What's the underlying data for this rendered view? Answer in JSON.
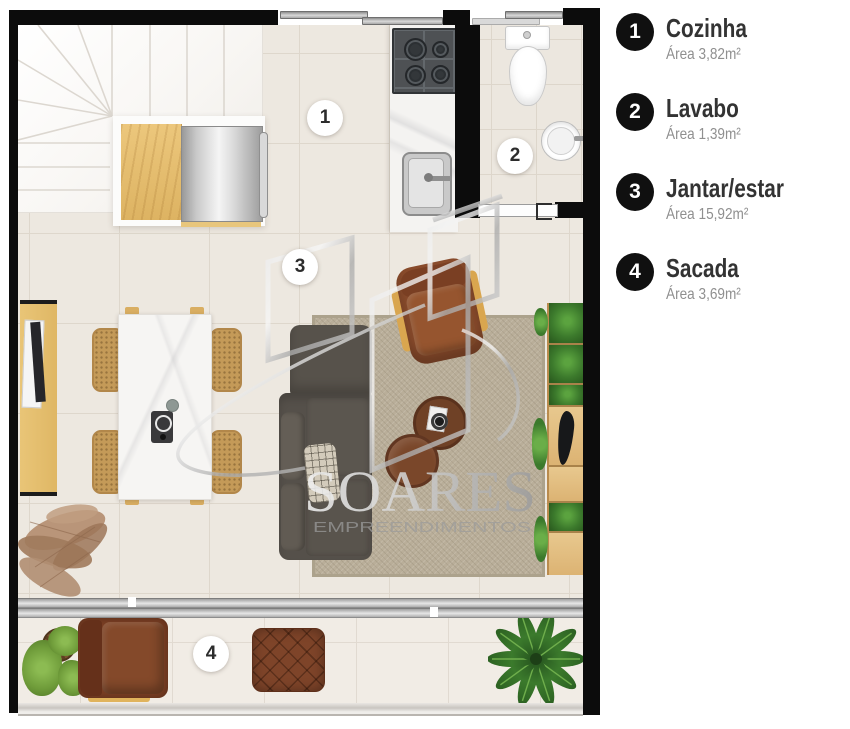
{
  "legend": {
    "items": [
      {
        "number": "1",
        "title": "Cozinha",
        "area": "Área 3,82m²"
      },
      {
        "number": "2",
        "title": "Lavabo",
        "area": "Área 1,39m²"
      },
      {
        "number": "3",
        "title": "Jantar/estar",
        "area": "Área 15,92m²"
      },
      {
        "number": "4",
        "title": "Sacada",
        "area": "Área 3,69m²"
      }
    ]
  },
  "plan": {
    "badges": [
      {
        "label": "1"
      },
      {
        "label": "2"
      },
      {
        "label": "3"
      },
      {
        "label": "4"
      }
    ]
  },
  "watermark": {
    "name": "SOARES",
    "tagline": "EMPREENDIMENTOS"
  },
  "colors": {
    "wall": "#0c0c0c",
    "floor": "#ede8e0",
    "legend_circle": "#101010",
    "legend_title": "#333333",
    "legend_area": "#8f8f8f",
    "watermark_silver": "#b5b5b5",
    "badge_background": "#ffffff"
  }
}
